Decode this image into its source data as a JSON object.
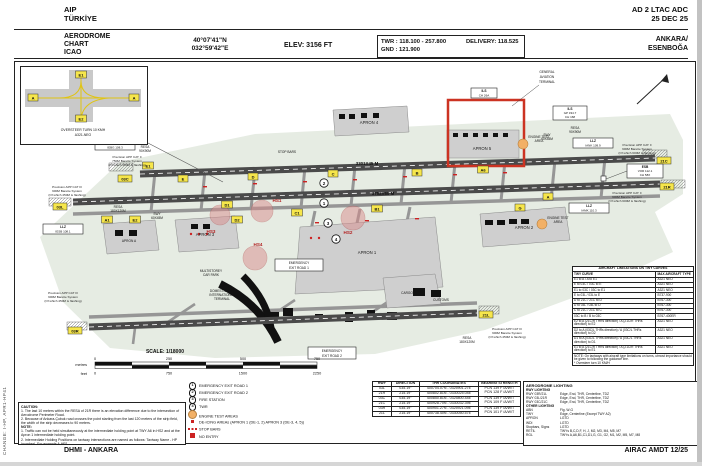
{
  "page": {
    "side_note": "CHANGE: I-HP, APR1-HP41",
    "footer_left": "DHMI - ANKARA",
    "footer_right": "AIRAC AMDT 12/25"
  },
  "header": {
    "aip": "AIP",
    "country": "TÜRKİYE",
    "doc_ref": "AD 2 LTAC ADC",
    "date": "25 DEC 25",
    "title1": "AERODROME",
    "title2": "CHART",
    "title3": "ICAO",
    "lat": "40°07'41\"N",
    "lon": "032°59'42\"E",
    "elev": "ELEV: 3156 FT",
    "twr": "TWR : 118.100 - 257.800",
    "gnd": "GND : 121.900",
    "delivery": "DELIVERY: 118.525",
    "city": "ANKARA/",
    "ad_name": "ESENBOĞA"
  },
  "inset": {
    "e1": "E1",
    "a1": "A",
    "a2": "A",
    "e2": "E2",
    "cap1": "OVERSTEER TURN 10 KMH",
    "cap2": "A321-NEO"
  },
  "chart": {
    "markers": [
      "1",
      "2",
      "3",
      "4"
    ],
    "rwy_len_top": "3301X45 M",
    "rwy_len_mid": "3752X60 M",
    "designators": {
      "tl": "03C",
      "tr": "21C",
      "ml": "03L",
      "mr": "21R",
      "bl": "03R",
      "br": "21L"
    },
    "twy_chips": [
      "A",
      "B",
      "C",
      "D",
      "E",
      "A1",
      "A6",
      "B1",
      "C1",
      "D1",
      "D2",
      "E1",
      "E2",
      "G"
    ],
    "hotspots": [
      "HS1",
      "HS2",
      "HS3",
      "HS4"
    ],
    "ga_terminal": [
      "GENERAL",
      "AVIATION",
      "TERMINAL"
    ],
    "aprons": {
      "a1": "APRON 1",
      "a2": "APRON 2",
      "a3": "APRON 3",
      "a4": "APRON 4",
      "a5": "APRON 5",
      "aa": "APRON A"
    },
    "cargo": "CARGO",
    "customs": "CUSTOMS",
    "car_park": [
      "MULTISTOREY",
      "CAR PARK"
    ],
    "terminal": [
      "DOMESTIC AND",
      "INTERNATIONAL",
      "TERMINAL"
    ],
    "em1": [
      "EMERGENCY",
      "EXIT ROAD 1"
    ],
    "em2": [
      "EMERGENCY",
      "EXIT ROAD 2"
    ],
    "engine": [
      "ENGINE TEST",
      "AREA"
    ],
    "stop_bars": "STOP BARS",
    "resa": [
      "RESA",
      "90X90M",
      "180X120M"
    ],
    "swy": [
      "SWY",
      "60X45M"
    ],
    "app1": [
      "Precision APP CAT II",
      "750M Barette System",
      "(Of which 450M is flashing)"
    ],
    "app2": [
      "Precision APP CAT III",
      "900M Barette System",
      "(Of which 450M is flashing)"
    ],
    "app3": [
      "Precision APP CAT II",
      "900M Barette System",
      "(Of which 600M is flashing)"
    ],
    "navaids": {
      "llz": "LLZ",
      "llz1": "IEBG 108.3",
      "llz2": "IESB 108.1",
      "llz3": "IANK 109.9",
      "llz4": "IAMK 110.3",
      "vor": [
        "ESB",
        "VOR 112.1",
        "CH 58X"
      ],
      "ils1": [
        "ILS",
        "GP 334.7",
        "CH 168"
      ],
      "ils2": [
        "ILS",
        "CH 26A"
      ]
    },
    "scale": {
      "title": "SCALE: 1/18000",
      "metres_label": "metres",
      "feet_label": "feet",
      "metres": [
        "0",
        "250",
        "500",
        "750"
      ],
      "feet": [
        "0",
        "750",
        "1500",
        "2250"
      ]
    }
  },
  "caution": {
    "title": "CAUTION:",
    "l1": "1. The last 10 meters within the RESA of 21R there is an elevation difference due to the intersection of Aerodrome Perimeter Road.",
    "l2": "2. Because of Ankara-Çubuk road crosses the point starting from the last 120 meters of the strip field, the width of the strip decreases to 90 meters.",
    "note_title": "NOTE:",
    "n1": "1. Traffic can not be held simultaneously at the intermediate holding point at TWY A6 in HS2 and at the Apron 1 intermediate holding point.",
    "n2": "2. Intermediate Holding Positions on taxiway intersections are named as follows: Taxiway Name - HP (number). For example A-HP1."
  },
  "legend": {
    "items": [
      {
        "num": "1",
        "label": "EMERGENCY EXIT ROAD 1"
      },
      {
        "num": "2",
        "label": "EMERGENCY EXIT ROAD 2"
      },
      {
        "num": "3",
        "label": "FIRE STATION"
      },
      {
        "num": "4",
        "label": "TWR"
      },
      {
        "num": "",
        "label": "ENGINE TEST AREAS"
      },
      {
        "num": "",
        "label": "DE-ICING AREAs (APRON 1 (DE-1, 2) APRON 3 (DE-3, 4, 5))"
      },
      {
        "num": "",
        "label": "STOP BARS"
      },
      {
        "num": "",
        "label": "NO ENTRY"
      }
    ]
  },
  "rwy_table": {
    "headers": [
      "RWY",
      "DIRECTION",
      "THR COORDINATES",
      "BEARING STRENGTH"
    ],
    "rows": [
      {
        "rwy": "03L",
        "dir": "035.19°",
        "thr": "400704.07N - 0325901.27E"
      },
      {
        "rwy": "21R",
        "dir": "215.19°",
        "thr": "400802.81N - 0330025.04E"
      },
      {
        "rwy": "03C",
        "dir": "035.19°",
        "thr": "400850.81N - 0325800.44E"
      },
      {
        "rwy": "21C",
        "dir": "215.19°",
        "thr": "400928.70N - 0330032.39E"
      },
      {
        "rwy": "03R",
        "dir": "035.19°",
        "thr": "400901.27N - 0325921.09E"
      },
      {
        "rwy": "21L",
        "dir": "215.19°",
        "thr": "400738.40N - 0330050.57E"
      }
    ],
    "strength": [
      {
        "l1": "PCN 139 F /A/W/T",
        "l2": "PCN 128 F /A/W/T"
      },
      {
        "l1": "PCN 139 F /A/W/T",
        "l2": "PCN 109 F /A/W/T"
      },
      {
        "l1": "PCN 139 F /A/W/T",
        "l2": "PCN 101 F /A/W/T"
      }
    ]
  },
  "lighting": {
    "title": "AERODROME LIGHTING",
    "rwy_title": "RWY LIGHTING",
    "rwy_rows": [
      {
        "k": "RWY 03R/21L",
        "v": "Edge, End, THR, Centerline, TDZ"
      },
      {
        "k": "RWY 03L/21R",
        "v": "Edge, End, THR, Centerline, TDZ"
      },
      {
        "k": "RWY 03C/21C",
        "v": "Edge, End, THR, Centerline, TDZ"
      }
    ],
    "other_title": "OTHER LIGHTING",
    "other_rows": [
      {
        "k": "ABN",
        "v": "Flg. W-G"
      },
      {
        "k": "TWY",
        "v": "Edge, Centerline (Except TWY A2)"
      },
      {
        "k": "APRON",
        "v": "LGTD"
      },
      {
        "k": "WDI",
        "v": "LGTD"
      },
      {
        "k": "Stopbars, Signs",
        "v": "LGTD"
      },
      {
        "k": "RETIL",
        "v": "TWYs B,C,D,F, H, J, M2, M3, M4, M5, M7"
      },
      {
        "k": "RGL",
        "v": "TWYs A,A6,B1,C1,D1,G, G1, G2, M1, M2, M5, M7, M8"
      }
    ]
  },
  "limitations": {
    "title": "AIRCRAFT LIMITATIONS ON TWY CURVES",
    "col1": "TWY CURVE",
    "col2": "MAX AIRCRAFT TYPE",
    "rows": [
      {
        "c": "E1 to A / A to E1",
        "t": "A321 NEO"
      },
      {
        "c": "E to 03C / 03C to E",
        "t": "A321 NEO"
      },
      {
        "c": "E1 to 03C / 03C to E1",
        "t": "A321 NEO"
      },
      {
        "c": "E to 03L / 03L to E",
        "t": "B737-900"
      },
      {
        "c": "D to 21C / 21C to D",
        "t": "B767-300"
      },
      {
        "c": "D to 03L / 03L to D",
        "t": "B767-300"
      },
      {
        "c": "C to 21C / 21C to C",
        "t": "B767-300"
      },
      {
        "c": "03C to B / B to 03C",
        "t": "B767-400ER"
      },
      {
        "c": "E2 to A (21C/R THRs direction) / A (21C/R THRs direction) to E2",
        "t": "A321 NEO"
      },
      {
        "c": "D2 to A (03C/L THRs direction) / A (03C/L THRs direction) to D2",
        "t": "A321 NEO"
      },
      {
        "c": "D1 to A (03C/L THRs direction) / A (03C/L THRs direction) to D1",
        "t": "A321 NEO"
      },
      {
        "c": "E1 to A (21C/R THRs direction) / A (21C/R THRs direction) to E1",
        "t": "A321 NEO"
      }
    ],
    "note": "NOTE: On taxiways with aircraft type limitations on turns, utmost importance should be given to following the guidance line.",
    "note2": "* Oversteer turn 10 KM/H"
  }
}
